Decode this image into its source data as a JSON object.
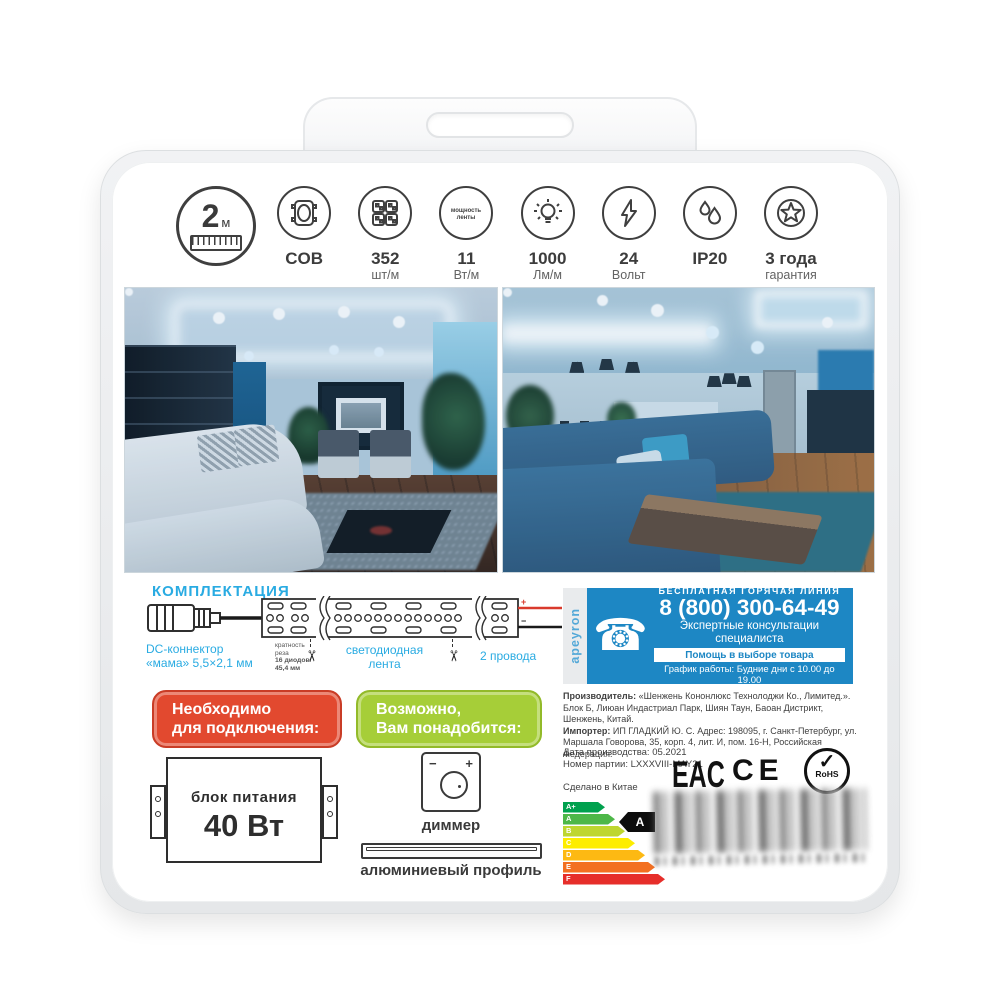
{
  "glyphs": {
    "phone": "☎",
    "scissors": "✂",
    "check": "✓"
  },
  "brand": {
    "vertical_logo": "apeyron"
  },
  "specs": {
    "items": [
      {
        "name": "length",
        "value": "2",
        "unit": "м"
      },
      {
        "name": "cob",
        "value": "COB",
        "sub": ""
      },
      {
        "name": "led-density",
        "value": "352",
        "sub": "шт/м"
      },
      {
        "name": "strip-power",
        "value": "11",
        "sub": "Вт/м",
        "icon_text_1": "мощность",
        "icon_text_2": "ленты"
      },
      {
        "name": "luminous-flux",
        "value": "1000",
        "sub": "Лм/м"
      },
      {
        "name": "voltage",
        "value": "24",
        "sub": "Вольт"
      },
      {
        "name": "ip-rating",
        "value": "IP20",
        "sub": ""
      },
      {
        "name": "warranty",
        "value": "3 года",
        "sub": "гарантия"
      }
    ]
  },
  "kit": {
    "title": "КОМПЛЕКТАЦИЯ",
    "dc_connector_line1": "DC-коннектор",
    "dc_connector_line2": "«мама» 5,5×2,1 мм",
    "cut_note_line1": "кратность",
    "cut_note_line2": "реза",
    "cut_note_line3": "16 диодов/",
    "cut_note_line4": "45,4 мм",
    "strip_label_line1": "светодиодная",
    "strip_label_line2": "лента",
    "wires_label": "2 провода",
    "wire_plus": "+",
    "wire_minus": "−"
  },
  "hotline": {
    "tagline": "БЕСПЛАТНАЯ ГОРЯЧАЯ ЛИНИЯ",
    "phone_number": "8 (800) 300-64-49",
    "subtitle": "Экспертные консультации специалиста",
    "badge": "Помощь в выборе товара",
    "schedule": "График работы: Будние дни с 10.00 до 19.00"
  },
  "legal": {
    "manufacturer_label": "Производитель:",
    "manufacturer_text": " «Шенжень Кононлюкс Технолоджи Ко., Лимитед.». Блок Б, Лиюан Индастриал Парк, Шиян Таун, Баоан Дистрикт, Шенжень, Китай.",
    "importer_label": "Импортер:",
    "importer_text": " ИП ГЛАДКИЙ Ю. С. Адрес: 198095, г. Санкт-Петербург, ул. Маршала Говорова, 35, корп. 4, лит. И, пом. 16-Н, Российская Федерация.",
    "production_date": "Дата производства: 05.2021",
    "batch_number": "Номер партии: LXXXVIII-MAY21",
    "made_in": "Сделано в Китае"
  },
  "required": {
    "title_line1": "Необходимо",
    "title_line2": "для подключения:",
    "psu_label": "блок питания",
    "psu_power": "40 Вт"
  },
  "optional": {
    "title_line1": "Возможно,",
    "title_line2": "Вам понадобится:",
    "dimmer_minus": "−",
    "dimmer_plus": "+",
    "dimmer_label": "диммер",
    "profile_label": "алюминиевый профиль"
  },
  "marks": {
    "eac": "EAC",
    "ce": "CE",
    "rohs": "RoHS"
  },
  "energy": {
    "rows": [
      {
        "letter": "A+",
        "color": "#00a14e",
        "width_px": 42
      },
      {
        "letter": "A",
        "color": "#4db748",
        "width_px": 52
      },
      {
        "letter": "B",
        "color": "#bed630",
        "width_px": 62
      },
      {
        "letter": "C",
        "color": "#fded00",
        "width_px": 72
      },
      {
        "letter": "D",
        "color": "#fdb913",
        "width_px": 82
      },
      {
        "letter": "E",
        "color": "#f37021",
        "width_px": 92
      },
      {
        "letter": "F",
        "color": "#e62e2a",
        "width_px": 102
      }
    ],
    "selected_letter": "A"
  },
  "colors": {
    "accent_cyan": "#29abe2",
    "hotline_blue": "#1d87c4",
    "required_red": "#e2492f",
    "optional_green": "#a6ce38"
  }
}
